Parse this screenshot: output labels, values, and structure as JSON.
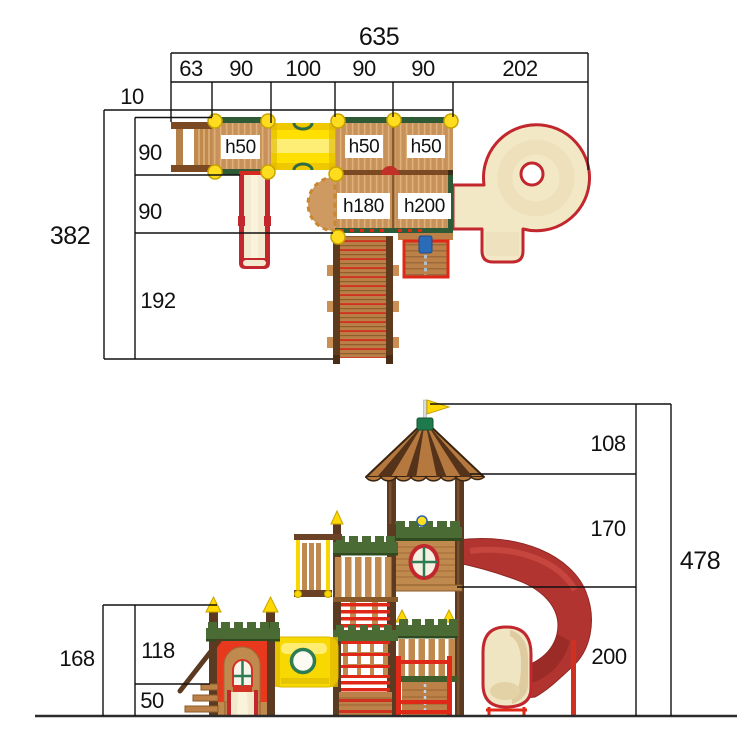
{
  "plan_view": {
    "width_total": "635",
    "width_segments": [
      "63",
      "90",
      "100",
      "90",
      "90",
      "202"
    ],
    "offset_top": "10",
    "depth_total": "382",
    "depth_segments": [
      "90",
      "90",
      "192"
    ],
    "platform_heights": [
      "h50",
      "h50",
      "h50",
      "h180",
      "h200"
    ]
  },
  "elevation_view": {
    "height_total": "478",
    "height_segments": [
      "108",
      "170",
      "200"
    ],
    "left_height_total": "168",
    "left_height_segments": [
      "118",
      "50"
    ]
  },
  "colors": {
    "wood": "#C6915A",
    "wood_dark": "#5B3A21",
    "trim_green": "#4A6B33",
    "tube_yellow": "#F7D800",
    "outline_red": "#C1272D",
    "slide_cream": "#F2E8C6",
    "slide_red": "#B23430",
    "dimension": "#111111"
  }
}
